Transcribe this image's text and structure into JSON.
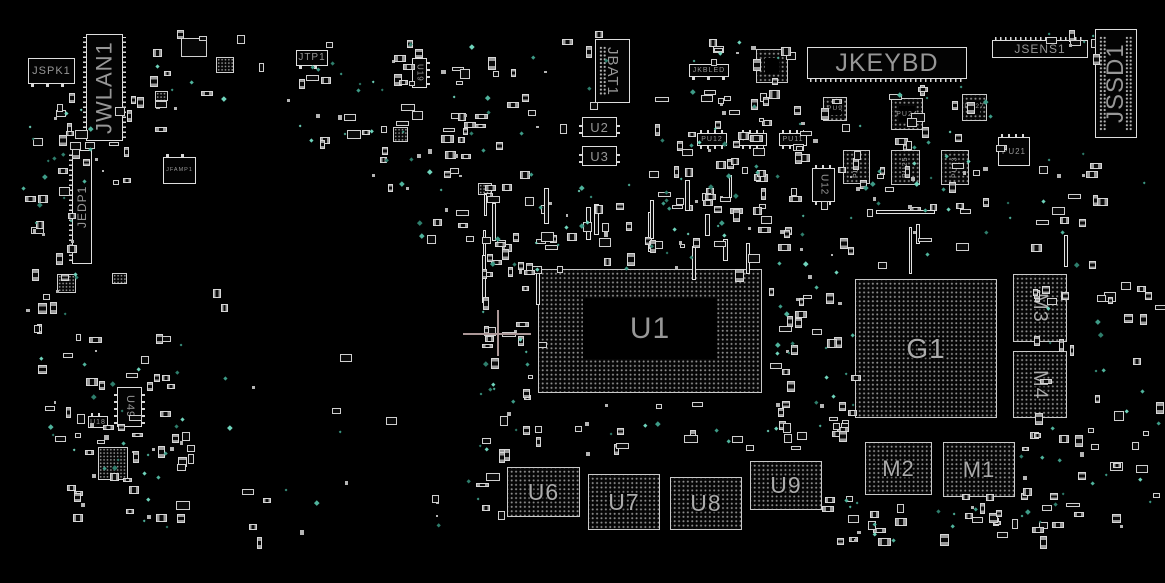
{
  "board": {
    "name": "motherboard-boardview",
    "background": "#000000",
    "colors": {
      "outline": "#dedede",
      "label": "#979797",
      "pads": "#8d8d8d",
      "pins": "#d8d8d8",
      "via": "#3d9b87",
      "crosshair": "#ab9797"
    },
    "crosshair": {
      "x": 497,
      "y": 333,
      "arm_h": 34,
      "arm_v": 23
    }
  },
  "components": [
    {
      "label": "JSPK1",
      "x": 28,
      "y": 58,
      "w": 47,
      "h": 26,
      "kind": "box",
      "dir": "h",
      "fs": 11,
      "pins": [
        [
          "b",
          "s"
        ]
      ]
    },
    {
      "label": "JWLAN1",
      "x": 86,
      "y": 34,
      "w": 37,
      "h": 107,
      "kind": "box",
      "dir": "vu",
      "fs": 22,
      "pins": [
        [
          "l",
          "d"
        ],
        [
          "r",
          "d"
        ]
      ]
    },
    {
      "label": "JEDP1",
      "x": 72,
      "y": 150,
      "w": 20,
      "h": 114,
      "kind": "box",
      "dir": "vu",
      "fs": 12,
      "pins": [
        [
          "l",
          "d"
        ]
      ]
    },
    {
      "label": "JFAMP1",
      "x": 163,
      "y": 157,
      "w": 33,
      "h": 27,
      "kind": "box",
      "dir": "h",
      "fs": 5.5,
      "pins": [
        [
          "t",
          "s"
        ]
      ]
    },
    {
      "label": "U49",
      "x": 117,
      "y": 387,
      "w": 25,
      "h": 40,
      "kind": "box",
      "dir": "vd",
      "fs": 11,
      "pins": [
        [
          "l",
          "m"
        ],
        [
          "r",
          "m"
        ]
      ]
    },
    {
      "label": "U18",
      "x": 88,
      "y": 416,
      "w": 20,
      "h": 12,
      "kind": "box",
      "dir": "h",
      "fs": 7,
      "pins": [
        [
          "t",
          "m"
        ]
      ]
    },
    {
      "label": "JTP1",
      "x": 296,
      "y": 50,
      "w": 32,
      "h": 16,
      "kind": "box",
      "dir": "h",
      "fs": 10,
      "pins": [
        [
          "b",
          "s"
        ]
      ]
    },
    {
      "label": "U19",
      "x": 412,
      "y": 58,
      "w": 15,
      "h": 30,
      "kind": "box",
      "dir": "vd",
      "fs": 8,
      "pins": [
        [
          "r",
          "m"
        ]
      ]
    },
    {
      "label": "JBAT1",
      "x": 595,
      "y": 39,
      "w": 35,
      "h": 64,
      "kind": "box",
      "dir": "vd",
      "fs": 15,
      "pins": [
        [
          "L",
          "dot"
        ]
      ]
    },
    {
      "label": "U2",
      "x": 582,
      "y": 117,
      "w": 35,
      "h": 20,
      "kind": "box",
      "dir": "h",
      "fs": 13,
      "pins": [
        [
          "l",
          "m"
        ],
        [
          "r",
          "m"
        ]
      ]
    },
    {
      "label": "U3",
      "x": 582,
      "y": 146,
      "w": 35,
      "h": 20,
      "kind": "box",
      "dir": "h",
      "fs": 13,
      "pins": [
        [
          "l",
          "m"
        ],
        [
          "r",
          "m"
        ]
      ]
    },
    {
      "label": "JKBLED",
      "x": 689,
      "y": 64,
      "w": 40,
      "h": 13,
      "kind": "box",
      "dir": "h",
      "fs": 7,
      "pins": [
        [
          "b",
          "s"
        ]
      ]
    },
    {
      "label": "",
      "x": 756,
      "y": 49,
      "w": 32,
      "h": 34,
      "kind": "ring",
      "dir": "h",
      "fs": 7,
      "inset": "8"
    },
    {
      "label": "JKEYBD",
      "x": 807,
      "y": 47,
      "w": 160,
      "h": 32,
      "kind": "box",
      "dir": "h",
      "fs": 25,
      "pins": [
        [
          "b",
          "d"
        ]
      ]
    },
    {
      "label": "JSENS1",
      "x": 992,
      "y": 40,
      "w": 96,
      "h": 18,
      "kind": "box",
      "dir": "h",
      "fs": 12,
      "pins": [
        [
          "t",
          "d"
        ]
      ]
    },
    {
      "label": "JSSD1",
      "x": 1095,
      "y": 29,
      "w": 42,
      "h": 109,
      "kind": "box",
      "dir": "vu",
      "fs": 24,
      "pins": [
        [
          "L",
          "dot"
        ],
        [
          "R",
          "dot"
        ]
      ]
    },
    {
      "label": "PU12",
      "x": 697,
      "y": 133,
      "w": 30,
      "h": 13,
      "kind": "box",
      "dir": "h",
      "fs": 7,
      "pins": [
        [
          "t",
          "m"
        ],
        [
          "b",
          "m"
        ]
      ]
    },
    {
      "label": "PU10",
      "x": 739,
      "y": 133,
      "w": 28,
      "h": 13,
      "kind": "box",
      "dir": "h",
      "fs": 7,
      "pins": [
        [
          "t",
          "m"
        ],
        [
          "b",
          "m"
        ]
      ]
    },
    {
      "label": "PU11",
      "x": 779,
      "y": 133,
      "w": 28,
      "h": 13,
      "kind": "box",
      "dir": "h",
      "fs": 7,
      "pins": [
        [
          "t",
          "m"
        ],
        [
          "b",
          "m"
        ]
      ]
    },
    {
      "label": "PU9",
      "x": 823,
      "y": 97,
      "w": 24,
      "h": 24,
      "kind": "ring",
      "dir": "h",
      "fs": 6.5,
      "inset": "5"
    },
    {
      "label": "PU24",
      "x": 891,
      "y": 98,
      "w": 32,
      "h": 32,
      "kind": "ring",
      "dir": "h",
      "fs": 7,
      "inset": "7"
    },
    {
      "label": "PU27",
      "x": 962,
      "y": 94,
      "w": 25,
      "h": 27,
      "kind": "ring",
      "dir": "h",
      "fs": 6.5,
      "inset": "6"
    },
    {
      "label": "PU21",
      "x": 998,
      "y": 137,
      "w": 32,
      "h": 29,
      "kind": "box",
      "dir": "h",
      "fs": 8,
      "pins": [
        [
          "t",
          "m"
        ]
      ]
    },
    {
      "label": "PU26",
      "x": 843,
      "y": 150,
      "w": 27,
      "h": 34,
      "kind": "bga",
      "dir": "vu",
      "fs": 7
    },
    {
      "label": "PU25",
      "x": 891,
      "y": 150,
      "w": 29,
      "h": 35,
      "kind": "bga",
      "dir": "vu",
      "fs": 7
    },
    {
      "label": "PU23",
      "x": 941,
      "y": 150,
      "w": 28,
      "h": 35,
      "kind": "bga",
      "dir": "vu",
      "fs": 7
    },
    {
      "label": "U12",
      "x": 812,
      "y": 168,
      "w": 23,
      "h": 34,
      "kind": "box",
      "dir": "vd",
      "fs": 10,
      "pins": [
        [
          "t",
          "m"
        ],
        [
          "b",
          "m"
        ]
      ]
    },
    {
      "label": "U1",
      "x": 538,
      "y": 269,
      "w": 224,
      "h": 124,
      "kind": "ring",
      "dir": "h",
      "fs": 30,
      "inset": "28 44 33 44"
    },
    {
      "label": "G1",
      "x": 855,
      "y": 279,
      "w": 142,
      "h": 139,
      "kind": "bga",
      "dir": "h",
      "fs": 28
    },
    {
      "label": "M3",
      "x": 1013,
      "y": 274,
      "w": 54,
      "h": 68,
      "kind": "bga",
      "dir": "vd",
      "fs": 20
    },
    {
      "label": "M4",
      "x": 1013,
      "y": 351,
      "w": 54,
      "h": 67,
      "kind": "bga",
      "dir": "vd",
      "fs": 20
    },
    {
      "label": "U6",
      "x": 507,
      "y": 467,
      "w": 73,
      "h": 50,
      "kind": "bga",
      "dir": "h",
      "fs": 23
    },
    {
      "label": "U7",
      "x": 588,
      "y": 474,
      "w": 72,
      "h": 56,
      "kind": "bga",
      "dir": "h",
      "fs": 23
    },
    {
      "label": "U8",
      "x": 670,
      "y": 477,
      "w": 72,
      "h": 53,
      "kind": "bga",
      "dir": "h",
      "fs": 23
    },
    {
      "label": "U9",
      "x": 750,
      "y": 461,
      "w": 72,
      "h": 49,
      "kind": "bga",
      "dir": "h",
      "fs": 23
    },
    {
      "label": "M2",
      "x": 865,
      "y": 442,
      "w": 67,
      "h": 53,
      "kind": "bga",
      "dir": "h",
      "fs": 22
    },
    {
      "label": "M1",
      "x": 943,
      "y": 442,
      "w": 72,
      "h": 55,
      "kind": "bga",
      "dir": "h",
      "fs": 22
    }
  ]
}
